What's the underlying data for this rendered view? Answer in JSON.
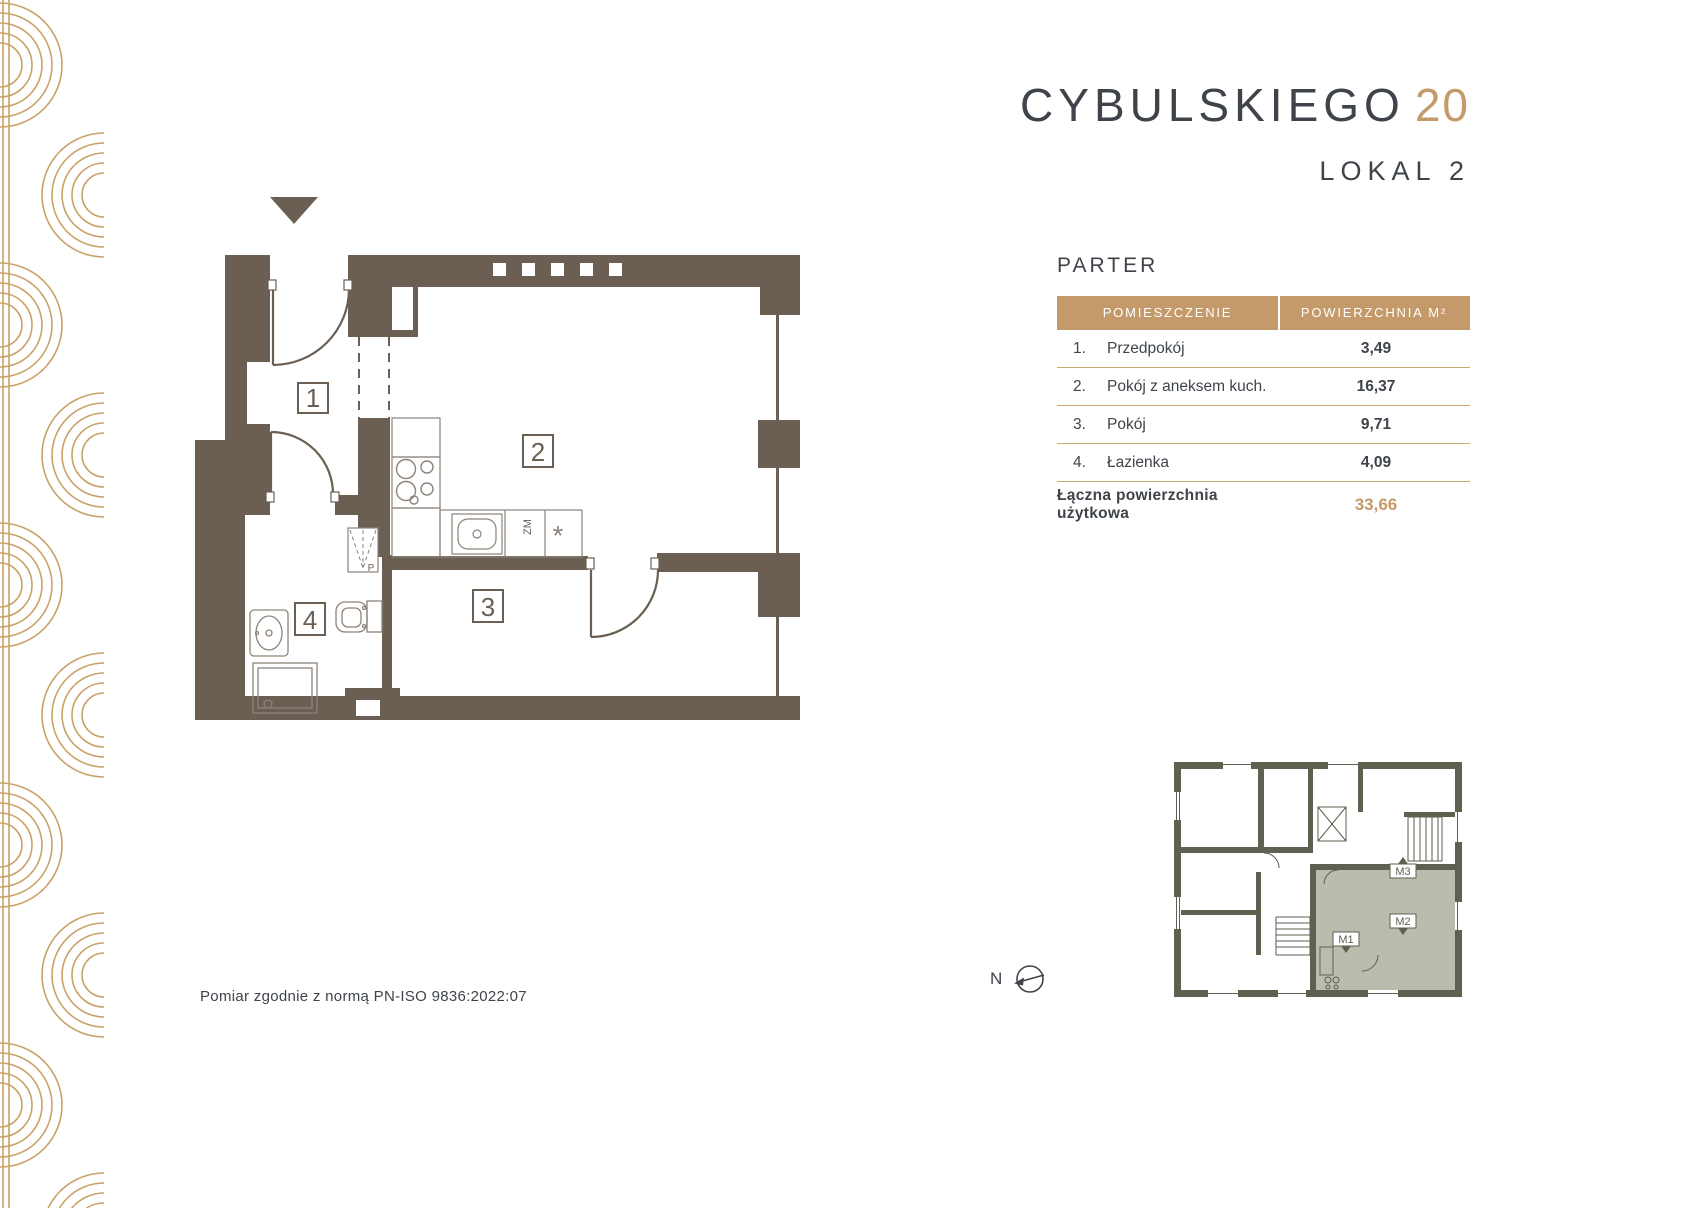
{
  "brand": {
    "name": "CYBULSKIEGO",
    "number": "20"
  },
  "unit_label": "LOKAL 2",
  "floor_label": "PARTER",
  "table": {
    "headers": [
      "POMIESZCZENIE",
      "POWIERZCHNIA M²"
    ],
    "rows": [
      {
        "no": "1.",
        "name": "Przedpokój",
        "area": "3,49"
      },
      {
        "no": "2.",
        "name": "Pokój z aneksem kuch.",
        "area": "16,37"
      },
      {
        "no": "3.",
        "name": "Pokój",
        "area": "9,71"
      },
      {
        "no": "4.",
        "name": "Łazienka",
        "area": "4,09"
      }
    ],
    "total_label": "Łączna powierzchnia użytkowa",
    "total_value": "33,66"
  },
  "plan": {
    "room_labels": [
      "1",
      "2",
      "3",
      "4"
    ],
    "dishwasher_label": "ZM",
    "fridge_symbol": "*",
    "shaft_label": "P"
  },
  "miniplan": {
    "unit_labels": [
      "M1",
      "M2",
      "M3"
    ]
  },
  "north_label": "N",
  "footer": "Pomiar zgodnie z normą PN-ISO 9836:2022:07",
  "colors": {
    "accent_gold": "#C49A6B",
    "deco_gold": "#C9A268",
    "wall": "#6A5F52",
    "text_dark": "#3E444A",
    "table_line": "#C9A872",
    "highlight_unit": "#B9BDAE",
    "miniplan_wall": "#5E6050"
  }
}
